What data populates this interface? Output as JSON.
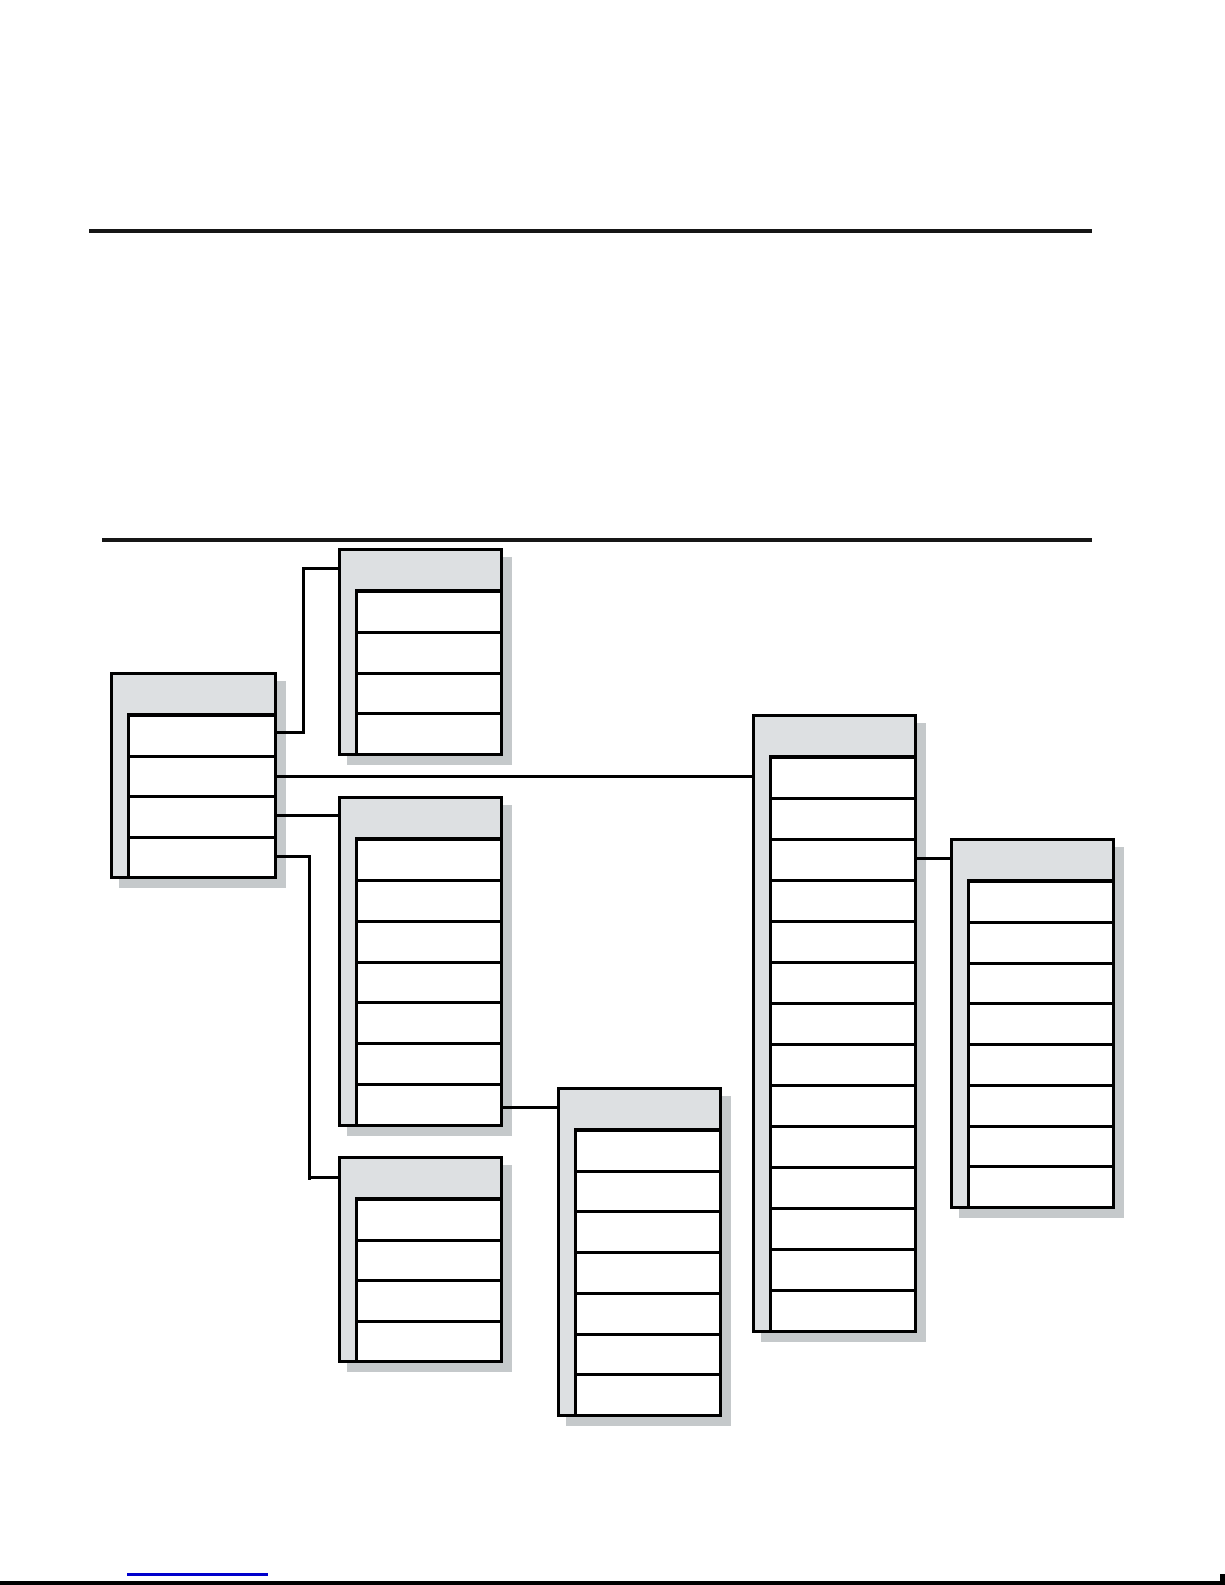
{
  "page": {
    "background": "#ffffff",
    "rule_color": "#161616",
    "bottom_edge_color": "#000000"
  },
  "rules": [
    {
      "name": "section-rule-top",
      "x": 89,
      "y": 229,
      "w": 1003,
      "h": 4
    },
    {
      "name": "section-rule-bottom",
      "x": 102,
      "y": 538,
      "w": 990,
      "h": 4
    }
  ],
  "diagram": {
    "type": "table-relationship-diagram",
    "description": "Seven unlabeled table boxes (gray header and left strip, white field rows, drop shadow) joined by right-angle connector lines; no text is rendered in any box",
    "box_style": {
      "fill": "#dde0e2",
      "row_fill": "#ffffff",
      "border_color": "#000000",
      "shadow_color": "#c5c9cb",
      "shadow_offset": 9,
      "header_height": 41,
      "row_inset_left": 17
    },
    "boxes": [
      {
        "id": "table-left",
        "x": 110,
        "y": 672,
        "w": 167,
        "h": 207,
        "rows": 4
      },
      {
        "id": "table-top-middle",
        "x": 338,
        "y": 548,
        "w": 165,
        "h": 208,
        "rows": 4
      },
      {
        "id": "table-middle",
        "x": 338,
        "y": 796,
        "w": 165,
        "h": 331,
        "rows": 7
      },
      {
        "id": "table-bottom-left",
        "x": 338,
        "y": 1156,
        "w": 165,
        "h": 207,
        "rows": 4
      },
      {
        "id": "table-bottom-middle",
        "x": 557,
        "y": 1087,
        "w": 165,
        "h": 330,
        "rows": 7
      },
      {
        "id": "table-tall-right",
        "x": 752,
        "y": 714,
        "w": 165,
        "h": 619,
        "rows": 14
      },
      {
        "id": "table-far-right",
        "x": 950,
        "y": 838,
        "w": 165,
        "h": 371,
        "rows": 8
      }
    ],
    "connector_color": "#000000",
    "connectors": [
      {
        "name": "left-to-top-middle",
        "segments": [
          [
            277,
            731,
            28,
            3
          ],
          [
            302,
            567,
            3,
            167
          ],
          [
            302,
            567,
            36,
            3
          ]
        ]
      },
      {
        "name": "left-to-tall-right",
        "segments": [
          [
            277,
            775,
            475,
            3
          ]
        ]
      },
      {
        "name": "left-to-middle",
        "segments": [
          [
            277,
            814,
            61,
            3
          ]
        ]
      },
      {
        "name": "left-to-bottom-left",
        "segments": [
          [
            277,
            855,
            34,
            3
          ],
          [
            308,
            855,
            3,
            325
          ],
          [
            308,
            1176,
            30,
            3
          ]
        ]
      },
      {
        "name": "middle-to-bottom-middle",
        "segments": [
          [
            503,
            1106,
            54,
            3
          ]
        ]
      },
      {
        "name": "tall-right-to-far-right",
        "segments": [
          [
            917,
            857,
            33,
            3
          ]
        ]
      }
    ]
  },
  "footer": {
    "link_underline_color": "#0000cc",
    "link_underline": {
      "x": 127,
      "y": 1573,
      "w": 141,
      "h": 3
    },
    "bottom_edge": {
      "x": 0,
      "y": 1581,
      "w": 1225,
      "h": 4
    },
    "corner_tick": {
      "x": 1220,
      "y": 1574,
      "w": 5,
      "h": 11
    }
  }
}
